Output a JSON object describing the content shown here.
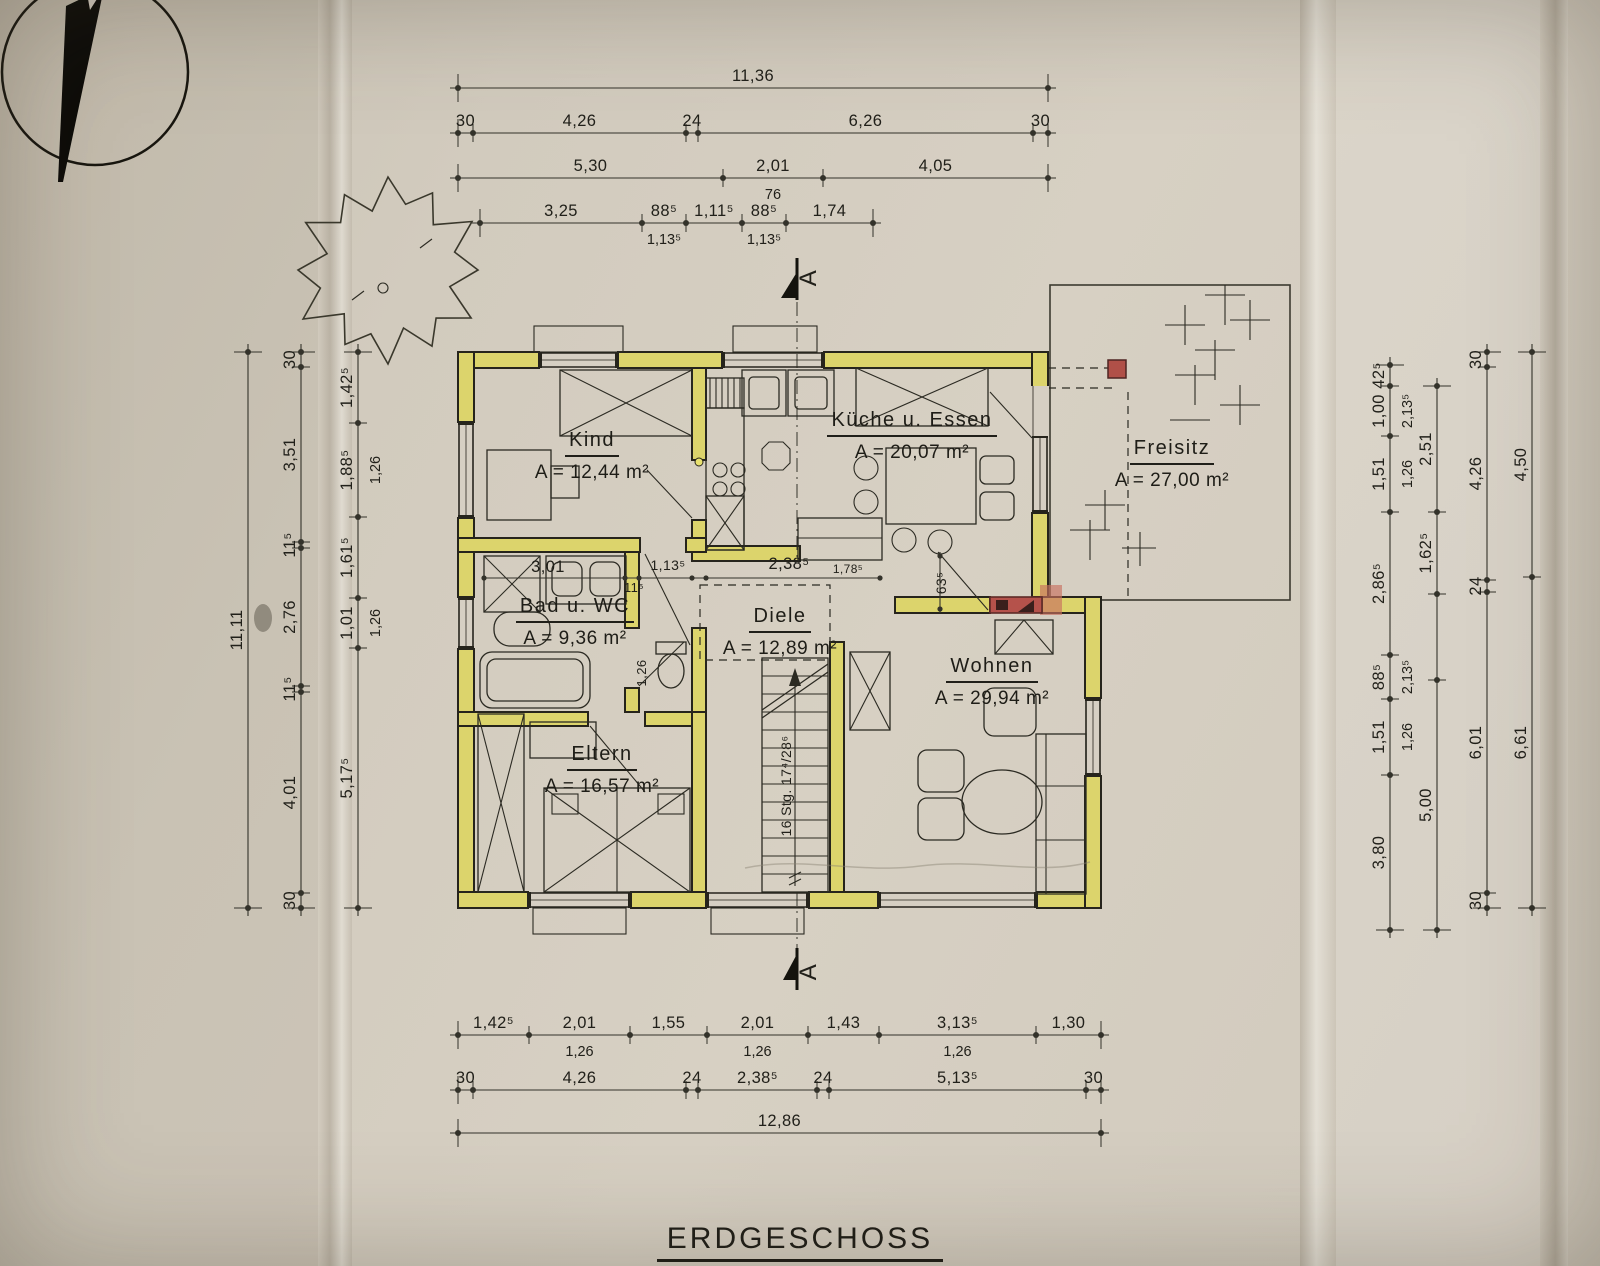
{
  "title": "ERDGESCHOSS",
  "rooms": [
    {
      "id": "kind",
      "name": "Kind",
      "area": "A = 12,44 m²"
    },
    {
      "id": "kueche",
      "name": "Küche u. Essen",
      "area": "A = 20,07 m²"
    },
    {
      "id": "freisitz",
      "name": "Freisitz",
      "area": "A = 27,00 m²"
    },
    {
      "id": "bad",
      "name": "Bad u. WC",
      "area": "A = 9,36 m²"
    },
    {
      "id": "diele",
      "name": "Diele",
      "area": "A = 12,89 m²"
    },
    {
      "id": "eltern",
      "name": "Eltern",
      "area": "A = 16,57 m²"
    },
    {
      "id": "wohnen",
      "name": "Wohnen",
      "area": "A = 29,94 m²"
    }
  ],
  "section_markers": [
    {
      "label": "A"
    },
    {
      "label": "A"
    }
  ],
  "dimensions": {
    "chains": [
      {
        "id": "top-overall",
        "orient": "h",
        "pos": 88,
        "pts": [
          458,
          1048
        ],
        "labels": [
          "11,36"
        ]
      },
      {
        "id": "top-main",
        "orient": "h",
        "pos": 133,
        "pts": [
          458,
          473,
          686,
          698,
          1033,
          1048
        ],
        "labels": [
          "30",
          "4,26",
          "24",
          "6,26",
          "30"
        ]
      },
      {
        "id": "top-row3",
        "orient": "h",
        "pos": 178,
        "pts": [
          458,
          723,
          823,
          1048
        ],
        "labels": [
          "5,30",
          "2,01",
          "4,05"
        ],
        "subs": {
          "1": "76"
        }
      },
      {
        "id": "top-row4",
        "orient": "h",
        "pos": 223,
        "pts": [
          480,
          642,
          686,
          742,
          786,
          873
        ],
        "labels": [
          "3,25",
          "88⁵",
          "1,11⁵",
          "88⁵",
          "1,74"
        ],
        "subs": {
          "1": "1,13⁵",
          "3": "1,13⁵"
        }
      },
      {
        "id": "bottom-openings",
        "orient": "h",
        "pos": 1035,
        "pts": [
          458,
          529,
          630,
          707,
          808,
          879,
          1036,
          1101
        ],
        "labels": [
          "1,42⁵",
          "2,01",
          "1,55",
          "2,01",
          "1,43",
          "3,13⁵",
          "1,30"
        ],
        "subs": {
          "1": "1,26",
          "3": "1,26",
          "5": "1,26"
        }
      },
      {
        "id": "bottom-main",
        "orient": "h",
        "pos": 1090,
        "pts": [
          458,
          473,
          686,
          698,
          817,
          829,
          1086,
          1101
        ],
        "labels": [
          "30",
          "4,26",
          "24",
          "2,38⁵",
          "24",
          "5,13⁵",
          "30"
        ]
      },
      {
        "id": "bottom-overall",
        "orient": "h",
        "pos": 1133,
        "pts": [
          458,
          1101
        ],
        "labels": [
          "12,86"
        ]
      },
      {
        "id": "left-overall",
        "orient": "v",
        "pos": 248,
        "pts": [
          352,
          908
        ],
        "labels": [
          "11,11"
        ]
      },
      {
        "id": "left-main",
        "orient": "v",
        "pos": 301,
        "pts": [
          352,
          367,
          542,
          548,
          686,
          692,
          893,
          908
        ],
        "labels": [
          "30",
          "3,51",
          "11⁵",
          "2,76",
          "11⁵",
          "4,01",
          "30"
        ]
      },
      {
        "id": "left-openings",
        "orient": "v",
        "pos": 358,
        "pts": [
          352,
          423,
          517,
          598,
          648,
          908
        ],
        "labels": [
          "1,42⁵",
          "1,88⁵",
          "1,61⁵",
          "1,01",
          "5,17⁵"
        ],
        "subs": {
          "1": "1,26",
          "3": "1,26"
        }
      },
      {
        "id": "right-openings",
        "orient": "v",
        "pos": 1390,
        "pts": [
          365,
          386,
          436,
          512,
          655,
          699,
          775,
          930
        ],
        "labels": [
          "42⁵",
          "1,00",
          "1,51",
          "2,86⁵",
          "88⁵",
          "1,51",
          "3,80"
        ],
        "subs": {
          "1": "2,13⁵",
          "2": "1,26",
          "4": "2,13⁵",
          "5": "1,26"
        }
      },
      {
        "id": "right-inner",
        "orient": "v",
        "pos": 1437,
        "pts": [
          386,
          512,
          594,
          680,
          930
        ],
        "labels": [
          "2,51",
          "1,62⁵",
          "",
          "5,00"
        ]
      },
      {
        "id": "right-main",
        "orient": "v",
        "pos": 1487,
        "pts": [
          352,
          367,
          580,
          592,
          893,
          908
        ],
        "labels": [
          "30",
          "4,26",
          "24",
          "6,01",
          "30"
        ]
      },
      {
        "id": "right-overall",
        "orient": "v",
        "pos": 1532,
        "pts": [
          352,
          577,
          908
        ],
        "labels": [
          "4,50",
          "6,61"
        ]
      }
    ],
    "free_labels": [
      {
        "t": "3,01",
        "x": 548,
        "y": 572
      },
      {
        "t": "11⁵",
        "x": 634,
        "y": 592,
        "size": 13
      },
      {
        "t": "1,13⁵",
        "x": 668,
        "y": 570,
        "size": 14
      },
      {
        "t": "2,38⁵",
        "x": 789,
        "y": 569
      },
      {
        "t": "1,78⁵",
        "x": 848,
        "y": 573,
        "size": 12
      },
      {
        "t": "63⁵",
        "x": 946,
        "y": 583,
        "rot": true,
        "size": 14
      },
      {
        "t": "1,26",
        "x": 646,
        "y": 673,
        "rot": true,
        "size": 13
      },
      {
        "t": "16 Stg. 17⁴/28⁶",
        "x": 791,
        "y": 786,
        "rot": true,
        "size": 14
      }
    ]
  },
  "colors": {
    "wall_fill": "#dcd46c",
    "wall_outline": "#26241c",
    "door_red": "#b5524b",
    "post_red": "#b05048",
    "ink": "#2b2a22",
    "paper": "#d3ccc0"
  }
}
